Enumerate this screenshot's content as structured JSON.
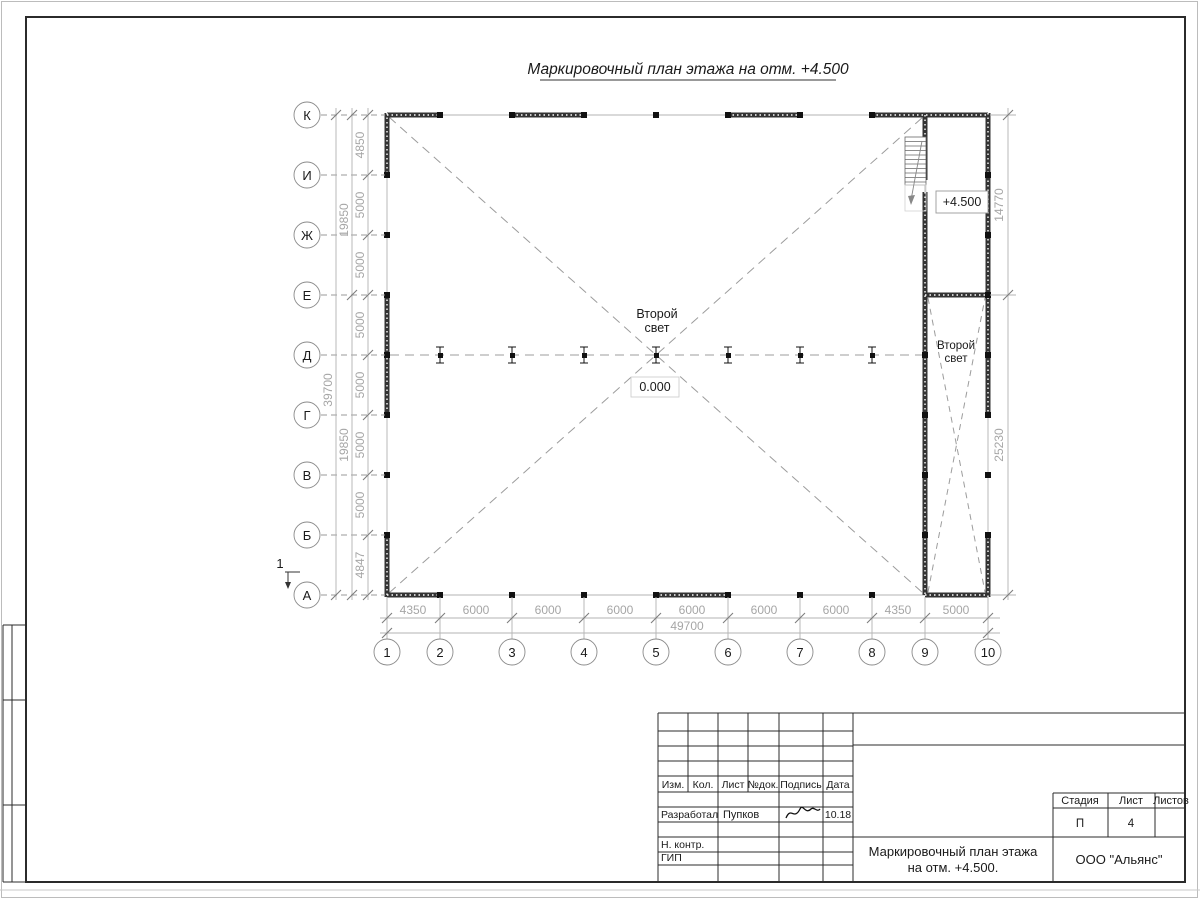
{
  "sheet": {
    "title": "Маркировочный план этажа на отм. +4.500",
    "section_mark": "1"
  },
  "plan": {
    "row_axes": [
      "К",
      "И",
      "Ж",
      "Е",
      "Д",
      "Г",
      "В",
      "Б",
      "А"
    ],
    "col_axes": [
      "1",
      "2",
      "3",
      "4",
      "5",
      "6",
      "7",
      "8",
      "9",
      "10"
    ],
    "dims_left_steps": [
      "4850",
      "5000",
      "5000",
      "5000",
      "5000",
      "5000",
      "5000",
      "4847"
    ],
    "dims_left_spans": [
      "19850",
      "19850"
    ],
    "dim_left_total": "39700",
    "dims_bottom_steps": [
      "4350",
      "6000",
      "6000",
      "6000",
      "6000",
      "6000",
      "6000",
      "4350",
      "5000"
    ],
    "dim_bottom_total": "49700",
    "dims_right": [
      "14770",
      "25230"
    ],
    "labels": {
      "second_light_main_1": "Второй",
      "second_light_main_2": "свет",
      "zero_level": "0.000",
      "upper_level": "+4.500",
      "second_light_right_1": "Второй",
      "second_light_right_2": "свет"
    }
  },
  "title_block": {
    "rev_headers": [
      "Изм.",
      "Кол.",
      "Лист",
      "№док.",
      "Подпись",
      "Дата"
    ],
    "rows": {
      "developed_label": "Разработал",
      "developed_name": "Пупков",
      "developed_date": "10.18",
      "ncontrol_label": "Н. контр.",
      "gip_label": "ГИП"
    },
    "stage_header": "Стадия",
    "sheet_header": "Лист",
    "sheets_header": "Листов",
    "stage_value": "П",
    "sheet_value": "4",
    "doc_title_1": "Маркировочный план этажа",
    "doc_title_2": "на отм. +4.500.",
    "company": "ООО \"Альянс\""
  }
}
